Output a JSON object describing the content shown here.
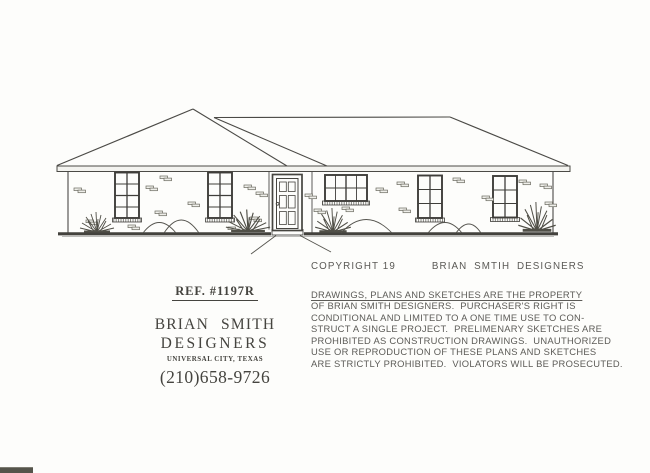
{
  "page": {
    "paper_color": "#fdfdfb",
    "ink_color": "#4b4a46"
  },
  "title_block": {
    "ref_number": "REF. #1197R",
    "company_name_line1": "BRIAN SMITH",
    "company_name_line2": "DESIGNERS",
    "location": "UNIVERSAL CITY, TEXAS",
    "phone": "(210)658-9726"
  },
  "copyright_block": {
    "copyright_line": "COPYRIGHT 19",
    "company": "BRIAN SMTIH DESIGNERS",
    "notice_lines": [
      "DRAWINGS, PLANS AND SKETCHES ARE THE PROPERTY",
      "OF BRIAN SMITH DESIGNERS.  PURCHASER'S RIGHT IS",
      "CONDITIONAL AND LIMITED TO A ONE TIME USE TO CON-",
      "STRUCT A SINGLE PROJECT.  PRELIMENARY SKETCHES ARE",
      "PROHIBITED AS CONSTRUCTION DRAWINGS.  UNAUTHORIZED",
      "USE OR REPRODUCTION OF THESE PLANS AND SKETCHES",
      "ARE STRICTLY PROHIBITED.  VIOLATORS WILL BE PROSECUTED."
    ]
  },
  "drawing": {
    "description": "single-story brick house front elevation"
  }
}
